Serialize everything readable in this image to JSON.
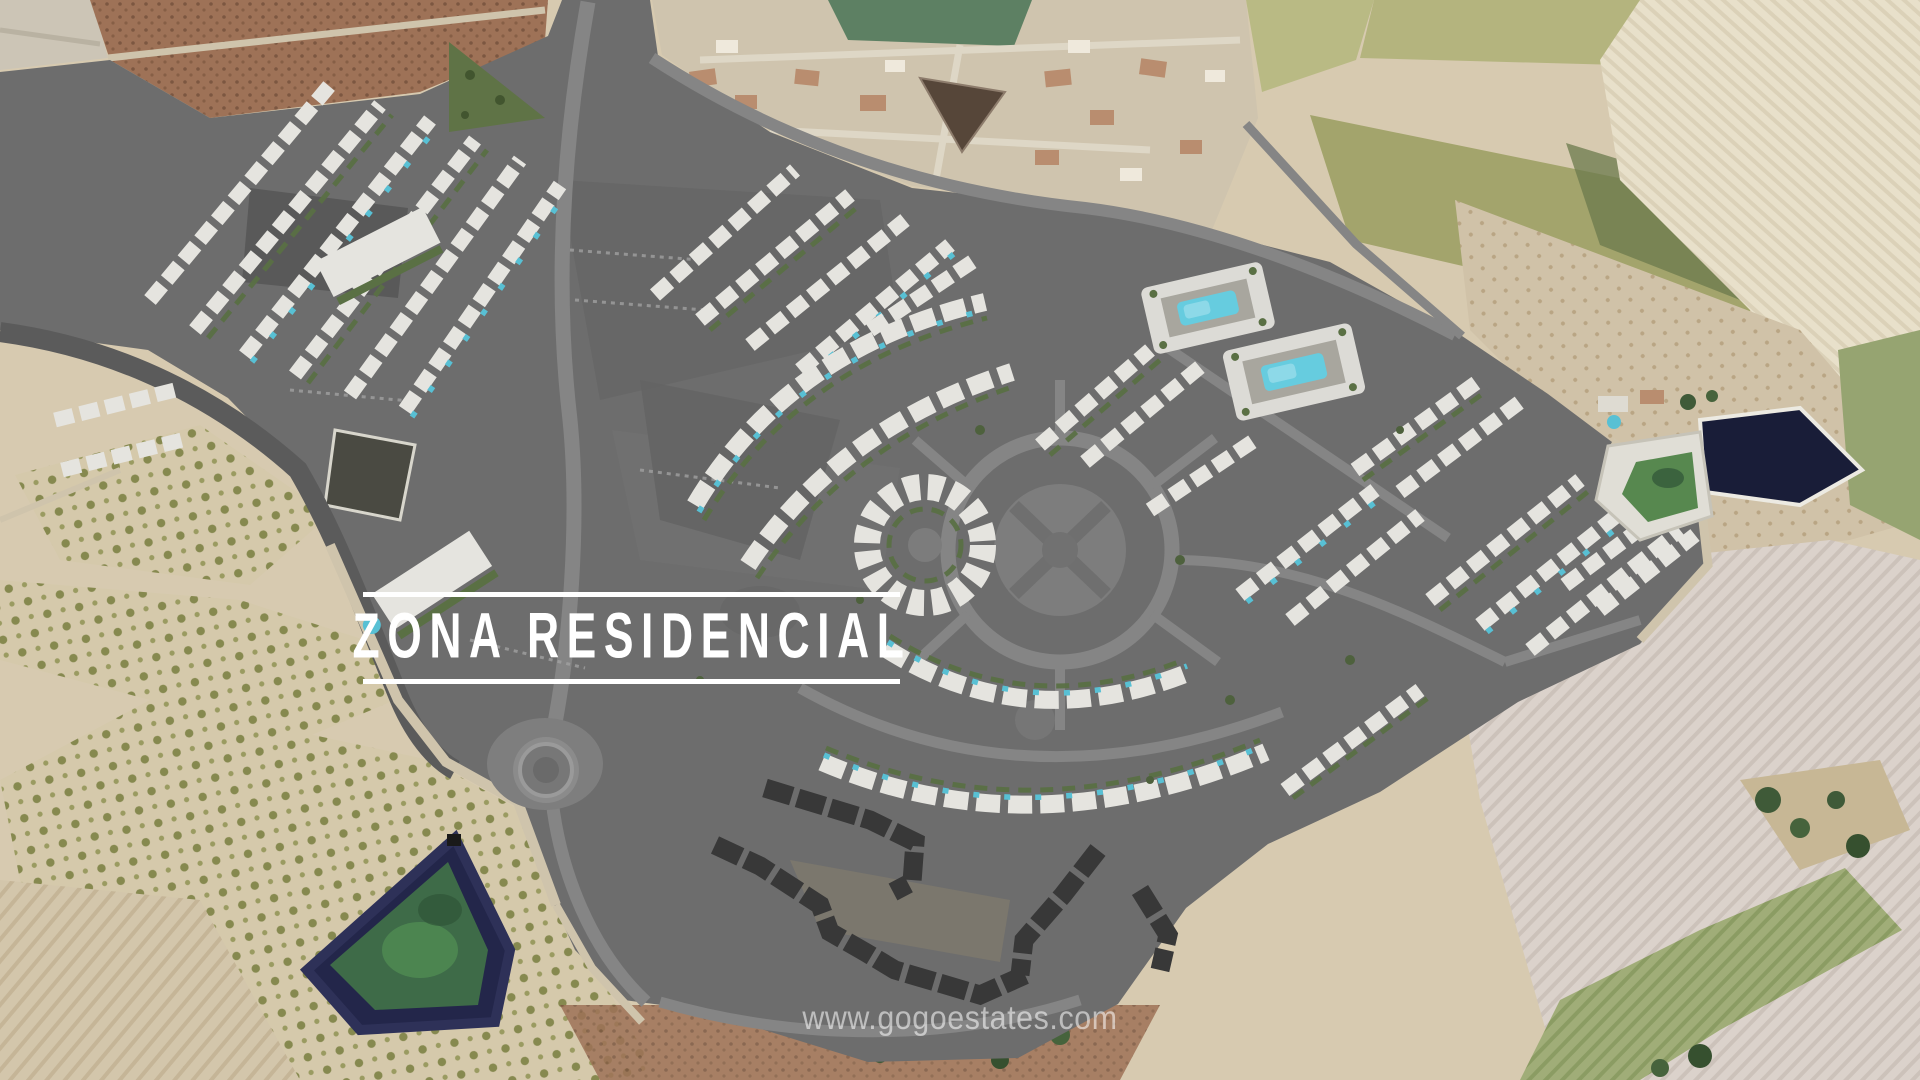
{
  "overlay": {
    "zone_label": "ZONA RESIDENCIAL",
    "watermark": "www.gogoestates.com"
  },
  "palette": {
    "development_gray": "#6d6d6d",
    "road_gray": "#858585",
    "building_white": "#e5e4df",
    "garden_green": "#5a7044",
    "pool_cyan": "#58c0d4",
    "dark_building": "#383838",
    "field_beige": "#d7cab0",
    "field_cream": "#e8e0ca",
    "field_olive": "#a3a46c",
    "field_brown": "#9e7257",
    "field_pale": "#dbd2cb",
    "town_beige": "#cfc4ae",
    "grass_green": "#5d8063",
    "pond_navy": "#1b2040",
    "pond_algae_green": "#3f6c49",
    "dirt_tan": "#cfc4ac",
    "banner_white": "#ffffff",
    "watermark_white": "rgba(255,255,255,0.55)"
  }
}
